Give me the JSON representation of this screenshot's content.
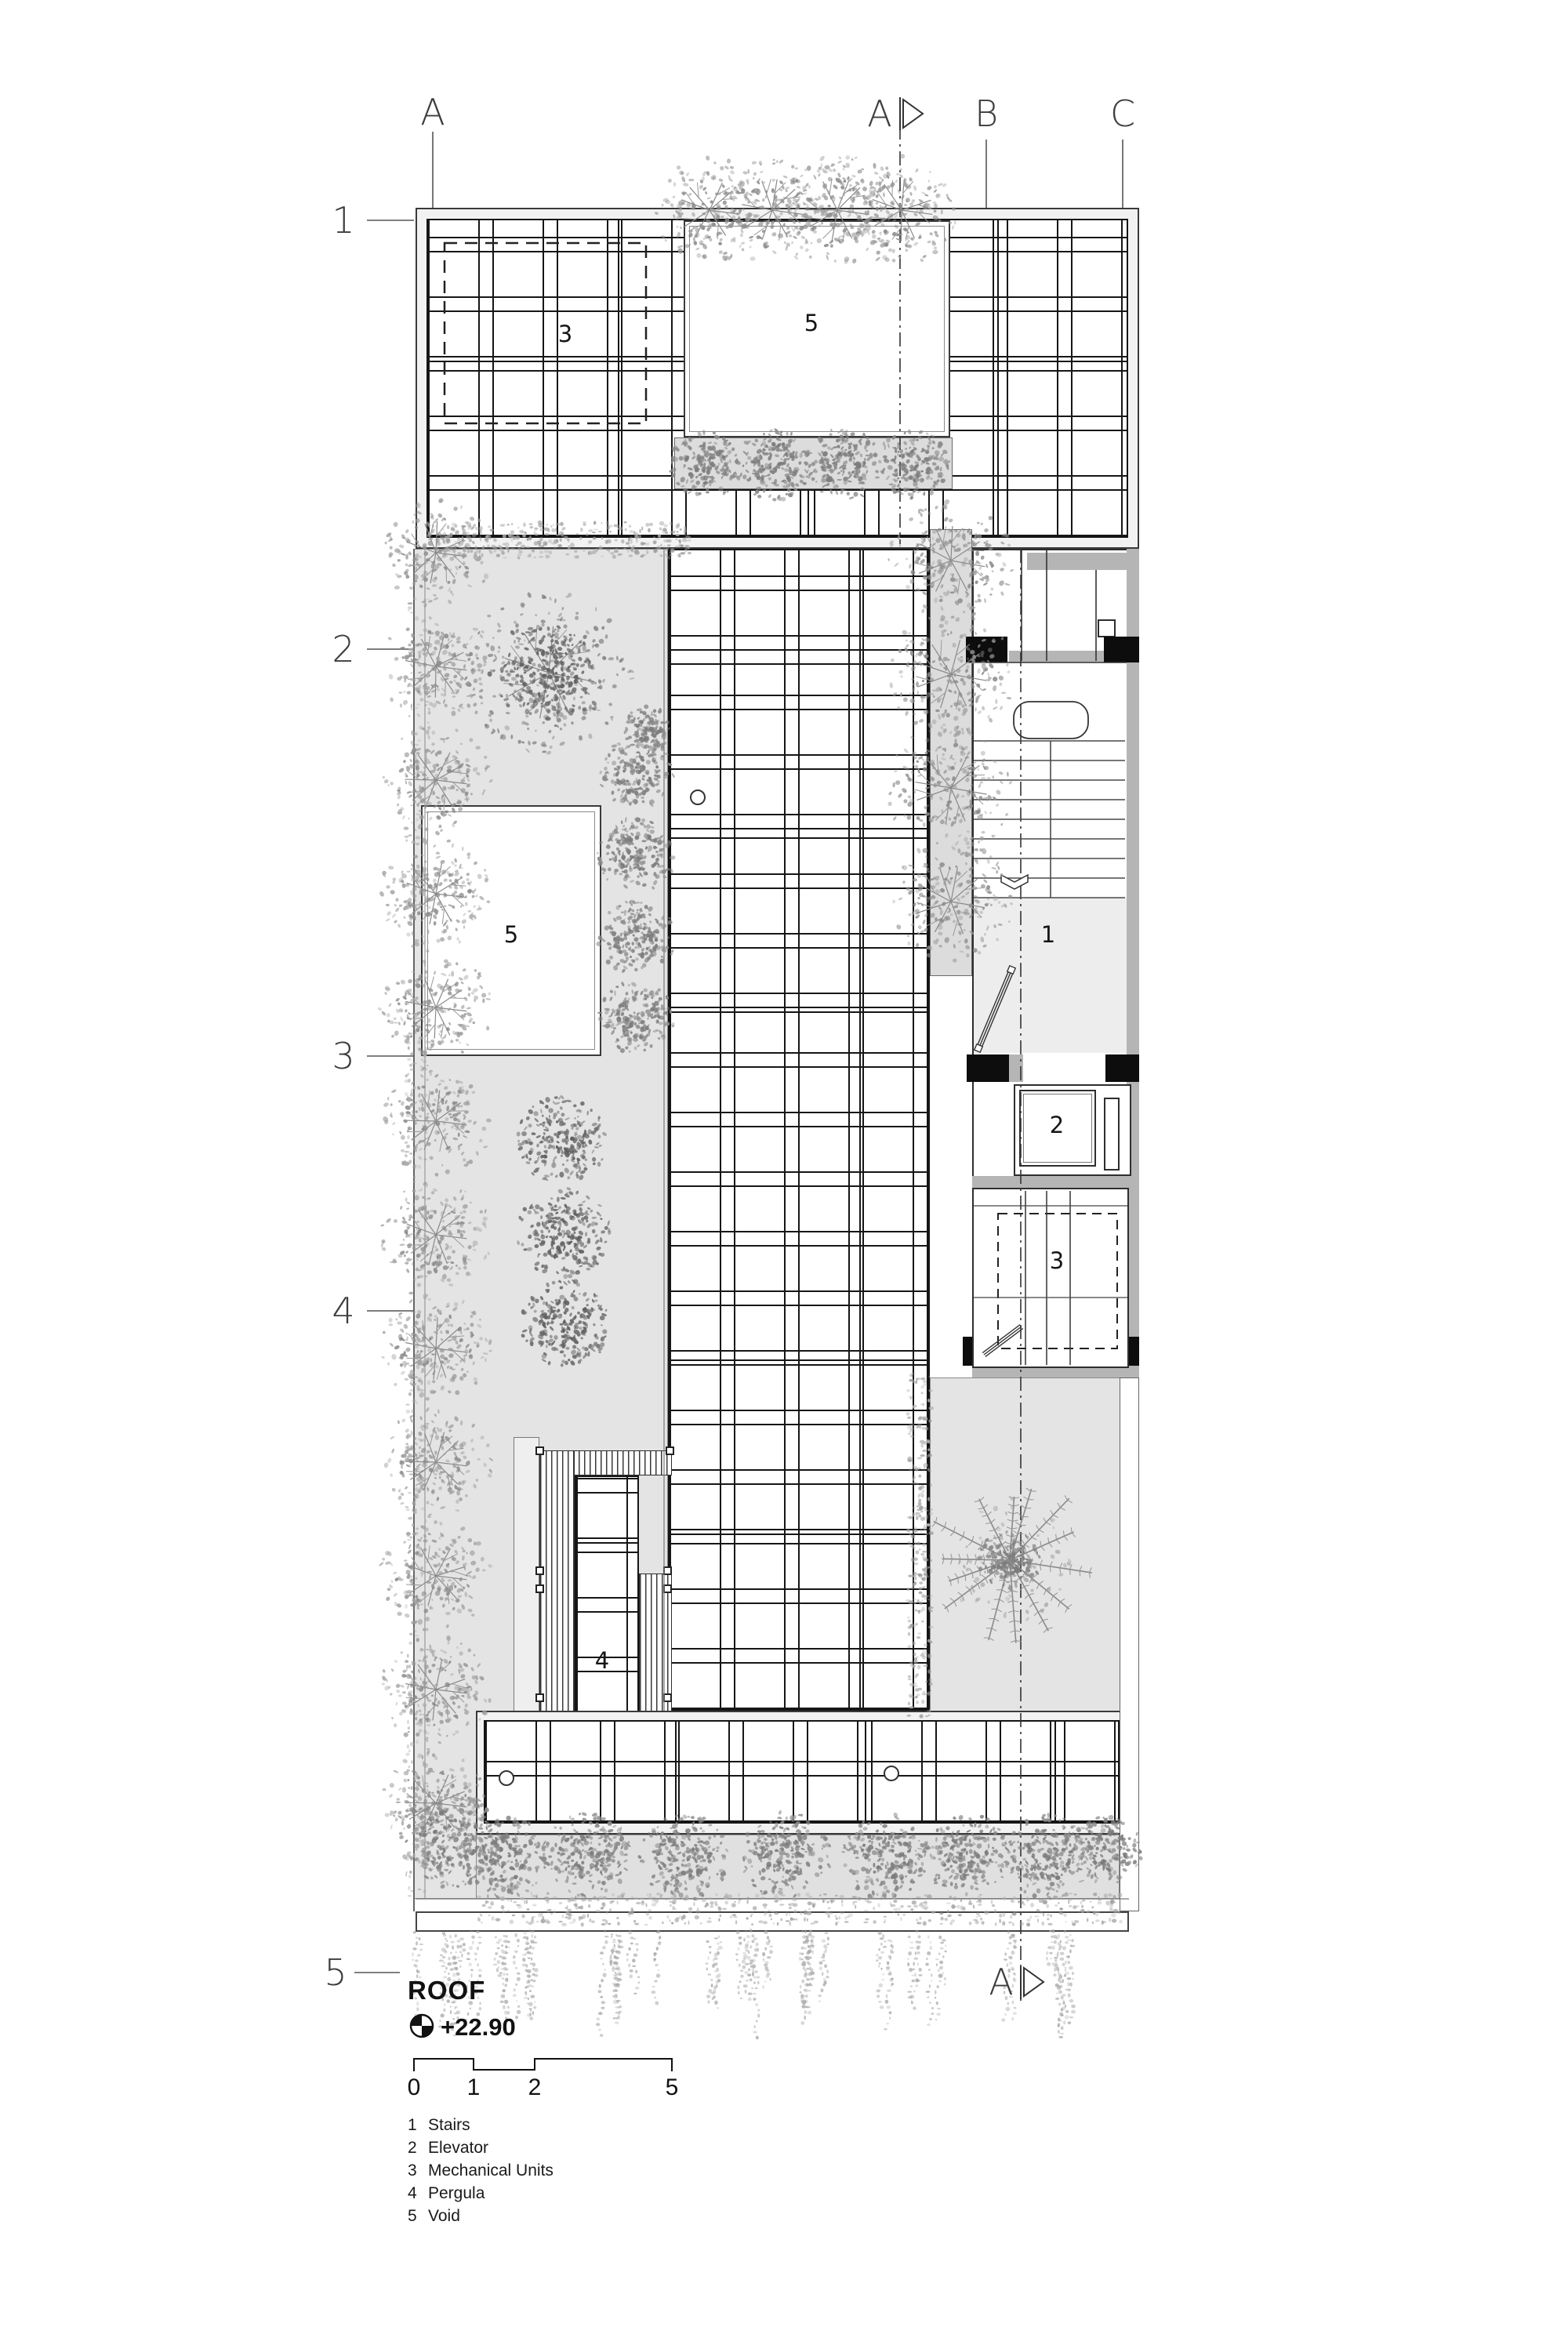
{
  "drawing": {
    "title": "ROOF",
    "level": "+22.90",
    "grid": {
      "columns": [
        "A",
        "B",
        "C"
      ],
      "rows": [
        "1",
        "2",
        "3",
        "4",
        "5"
      ]
    },
    "section_marker": "A",
    "area_labels": {
      "stairs": "1",
      "elevator": "2",
      "mechanical": "3",
      "pergola": "4",
      "void": "5"
    },
    "scale_bar": {
      "ticks": [
        "0",
        "1",
        "2",
        "5"
      ]
    },
    "legend": [
      {
        "num": "1",
        "label": "Stairs"
      },
      {
        "num": "2",
        "label": "Elevator"
      },
      {
        "num": "3",
        "label": "Mechanical Units"
      },
      {
        "num": "4",
        "label": "Pergula"
      },
      {
        "num": "5",
        "label": "Void"
      }
    ],
    "colors": {
      "terrace": "#e4e4e4",
      "planter": "#dcdcdc",
      "wall_poche": "#b5b5b5",
      "line": "#1a1a1a"
    }
  }
}
